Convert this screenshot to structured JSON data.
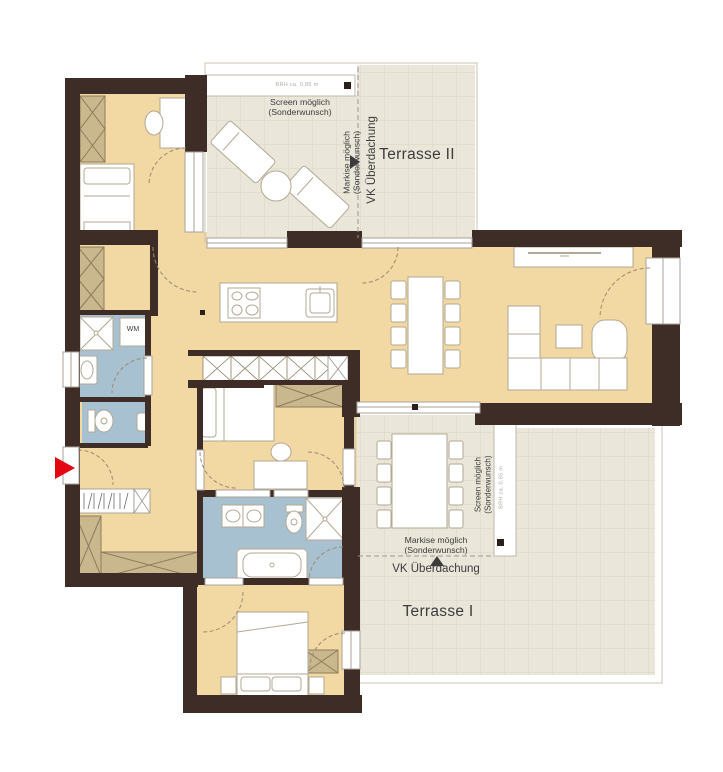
{
  "meta": {
    "plan_type": "floor-plan"
  },
  "labels": {
    "terrace2": "Terrasse II",
    "terrace1": "Terrasse I",
    "vk_top": "VK Überdachung",
    "vk_bottom": "VK Überdachung",
    "screen_top_1": "Screen möglich",
    "screen_top_2": "(Sonderwunsch)",
    "markise_top_1": "Markise möglich",
    "markise_top_2": "(Sonderwunsch)",
    "screen_right_1": "Screen möglich",
    "screen_right_2": "(Sonderwunsch)",
    "markise_bottom_1": "Markise möglich",
    "markise_bottom_2": "(Sonderwunsch)",
    "brh_top": "BRH ca. 0,85 m",
    "brh_right": "BRH ca. 0,85 m",
    "wm": "WM"
  },
  "colors": {
    "wall": "#3e2d26",
    "floor": "#f2d8a2",
    "wet": "#a7c1d0",
    "terrace": "#eae6d9",
    "terrace-grid": "#dbd5c3",
    "hatch": "#c9b78d",
    "hatch-line": "#8d7c5c",
    "furn": "#b3a894",
    "accent": "#e30613",
    "label": "#3c3c3c",
    "window-line": "#a9a299"
  }
}
